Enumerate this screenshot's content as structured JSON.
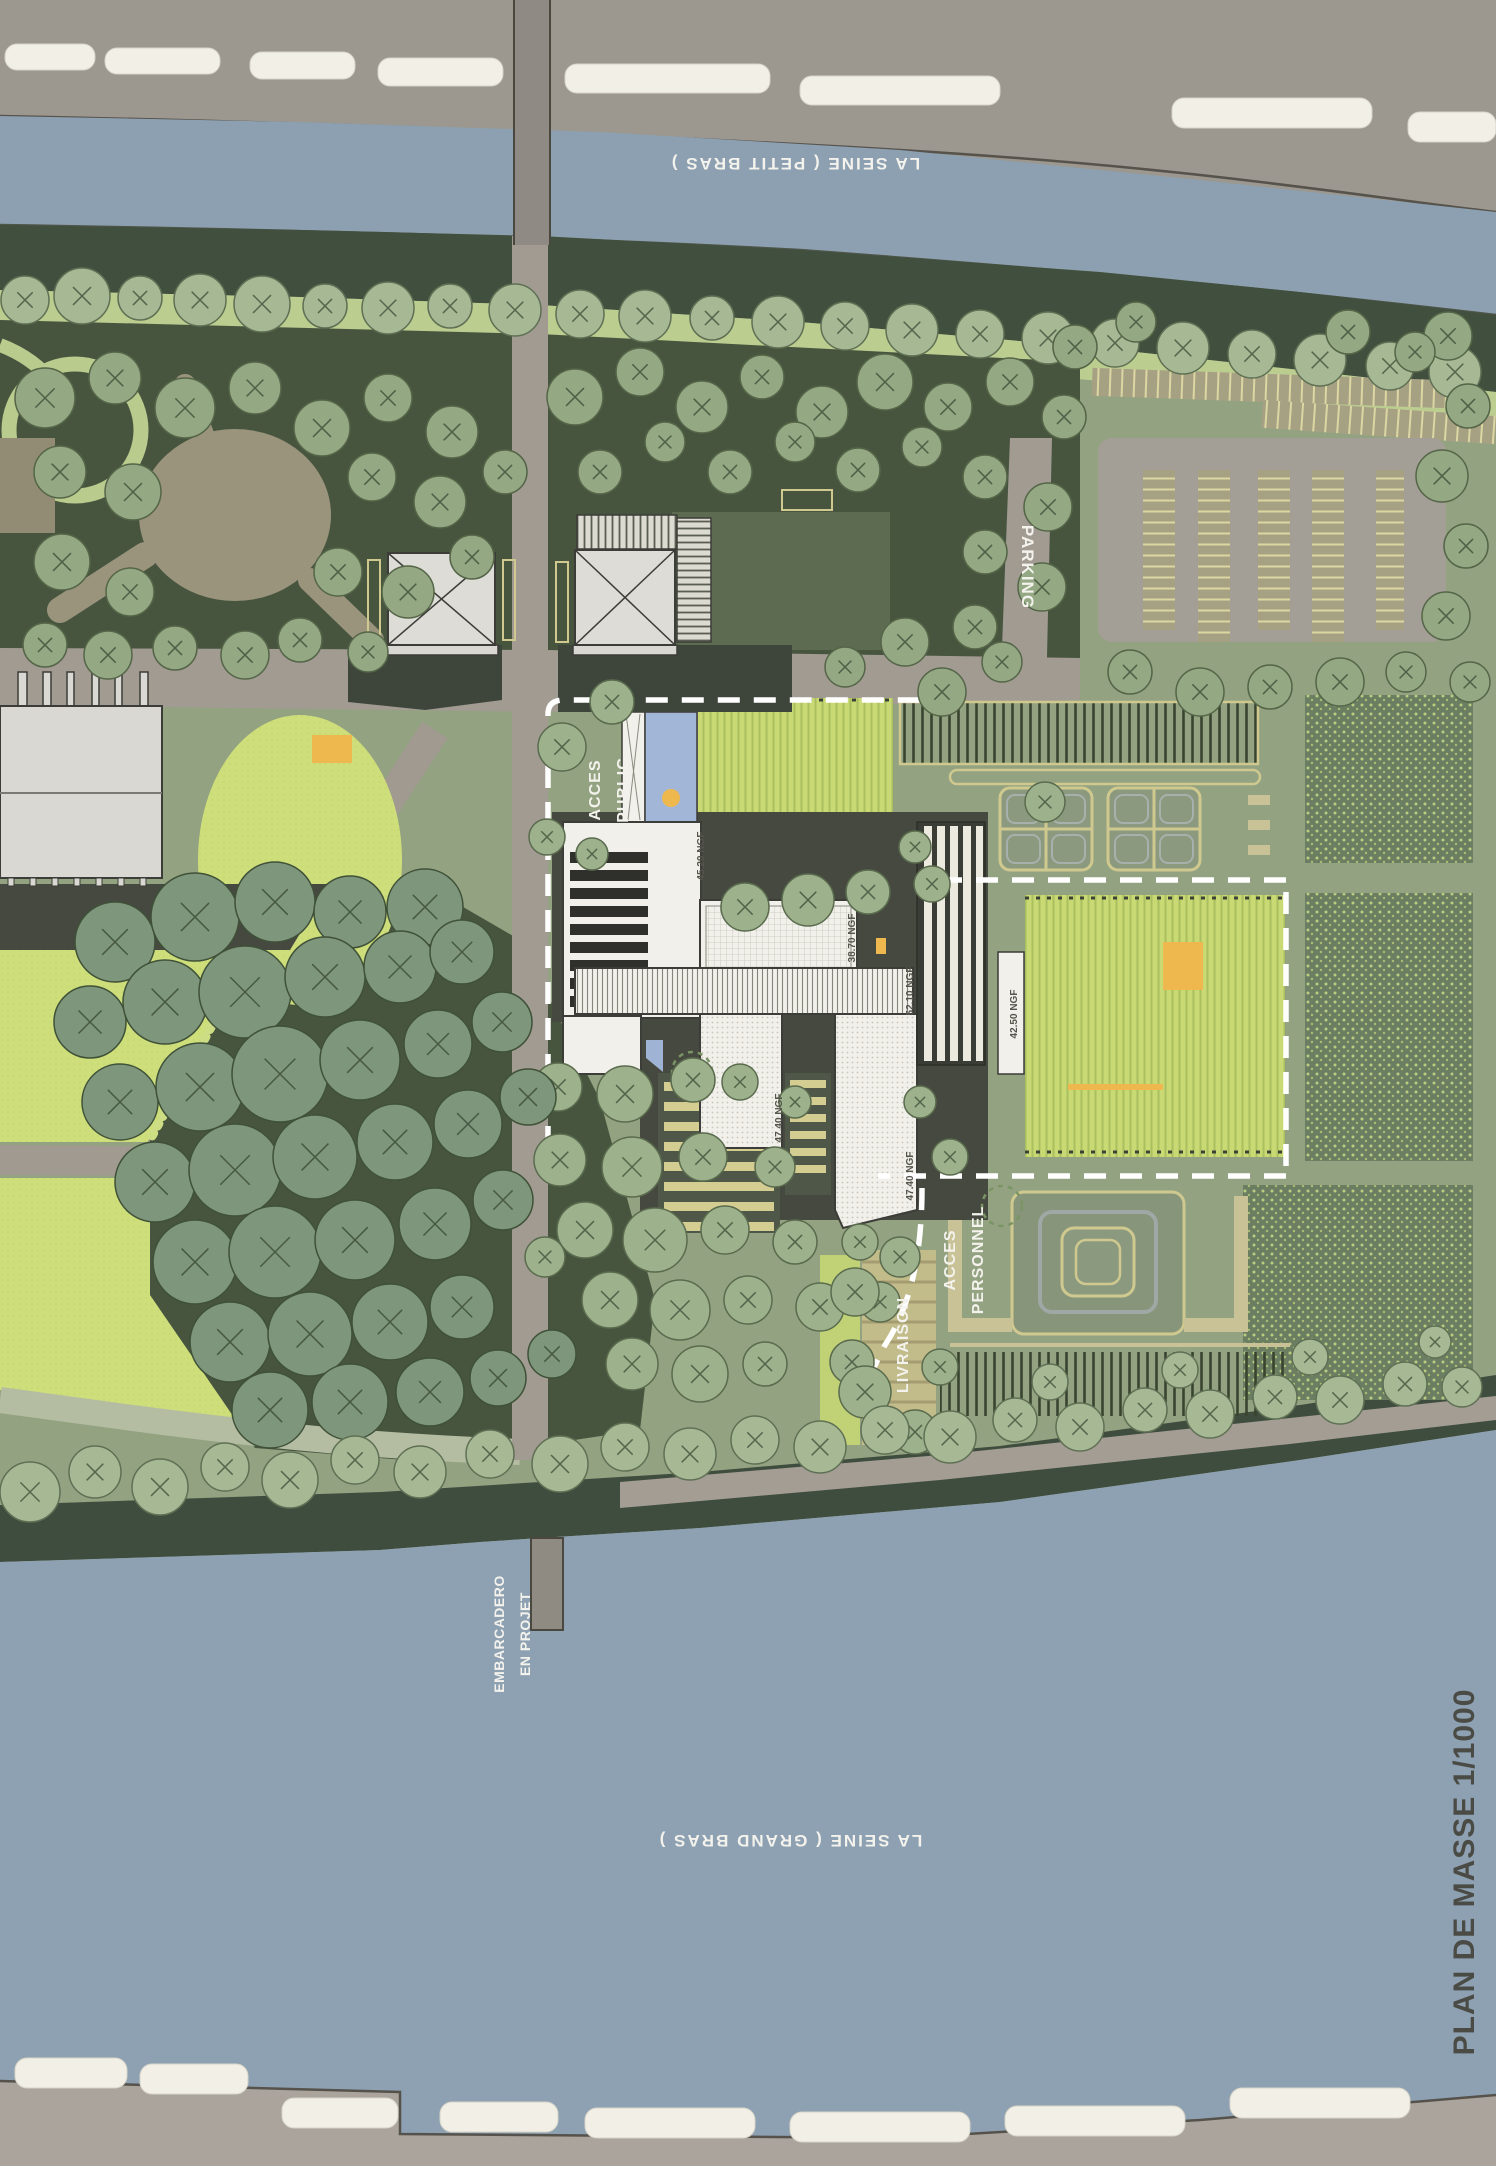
{
  "title": "PLAN DE MASSE 1/1000",
  "labels": {
    "river_top": "LA SEINE ( PETIT BRAS )",
    "river_bottom": "LA SEINE ( GRAND BRAS )",
    "parking": "PARKING",
    "acces_public_1": "ACCES",
    "acces_public_2": "PUBLIC",
    "acces_personnel_1": "ACCES",
    "acces_personnel_2": "PERSONNEL",
    "livraison": "LIVRAISON",
    "embarcadero_1": "EMBARCADERO",
    "embarcadero_2": "EN PROJET"
  },
  "elevations": {
    "building_a": "45.20 NGF",
    "building_b": "38.70 NGF",
    "building_c": "52.10 NGF",
    "building_d": "47.40 NGF",
    "building_e": "47.40 NGF",
    "building_g": "42.50 NGF"
  },
  "colors": {
    "water": "#8da0b1",
    "road": "#9c978f",
    "park_dark": "#47553f",
    "sage": "#93a281",
    "lawn_bright": "#cede7b",
    "khaki": "#cfc98f",
    "building_white": "#f1f0ea",
    "accent_orange": "#eeb84e",
    "pool_blue": "#a2b7d7",
    "boundary_white": "#ffffff"
  }
}
